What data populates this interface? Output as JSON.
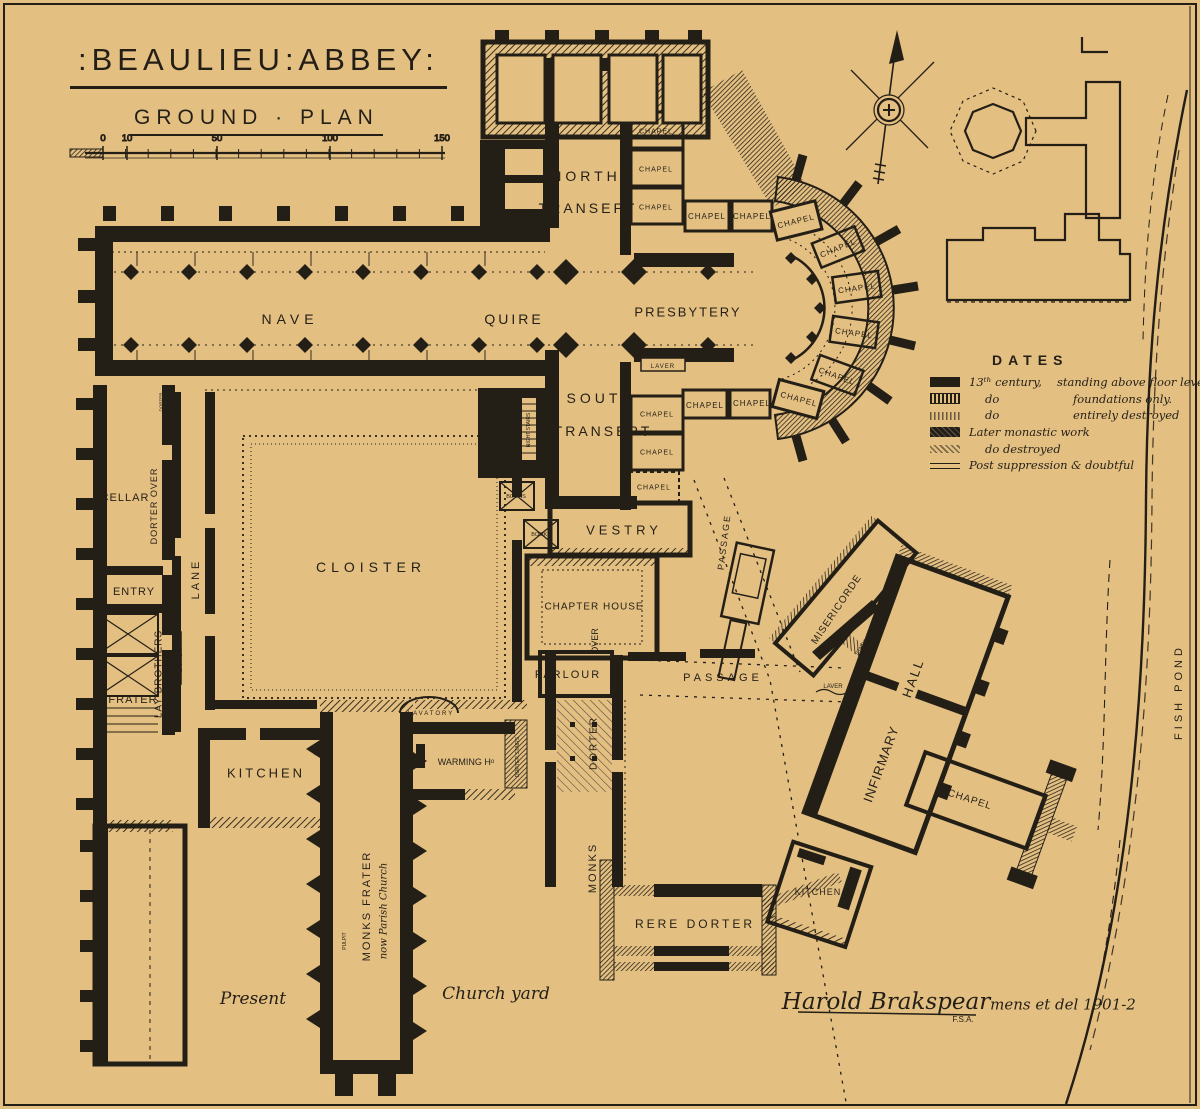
{
  "page": {
    "background": "#e3bf82",
    "ink": "#241f16"
  },
  "header": {
    "title": ":BEAULIEU:ABBEY:",
    "subtitle": "GROUND · PLAN"
  },
  "scale_bar": {
    "unit_ticks": [
      {
        "label": "0",
        "x": 103
      },
      {
        "label": "10",
        "x": 127
      },
      {
        "label": "50",
        "x": 217
      },
      {
        "label": "100",
        "x": 330
      },
      {
        "label": "150",
        "x": 442
      }
    ]
  },
  "legend": {
    "title": "DATES",
    "items": [
      {
        "swatch": "sw-solid",
        "t1": "13ᵗʰ century,",
        "t2": "standing above floor levels",
        "ind": false
      },
      {
        "swatch": "sw-found",
        "t1": "do",
        "t2": "foundations only.",
        "ind": true
      },
      {
        "swatch": "sw-destroyed",
        "t1": "do",
        "t2": "entirely destroyed",
        "ind": true
      },
      {
        "swatch": "sw-later",
        "t1": "Later monastic work",
        "t2": "",
        "ind": false
      },
      {
        "swatch": "sw-later-destroyed",
        "t1": "do  destroyed",
        "t2": "",
        "ind": true
      },
      {
        "swatch": "sw-post",
        "t1": "Post suppression & doubtful",
        "t2": "",
        "ind": false
      }
    ]
  },
  "plan": {
    "labels": [
      {
        "t": "NORTH",
        "x": 586,
        "y": 176,
        "s": 14,
        "ls": 4
      },
      {
        "t": "TRANSEPT",
        "x": 588,
        "y": 208,
        "s": 14,
        "ls": 3
      },
      {
        "t": "CHAPEL",
        "x": 656,
        "y": 131,
        "s": 7,
        "ls": 1
      },
      {
        "t": "CHAPEL",
        "x": 656,
        "y": 169,
        "s": 7,
        "ls": 1
      },
      {
        "t": "CHAPEL",
        "x": 656,
        "y": 207,
        "s": 7,
        "ls": 1
      },
      {
        "t": "CHAPEL",
        "x": 707,
        "y": 216,
        "s": 8,
        "ls": 1
      },
      {
        "t": "CHAPEL",
        "x": 752,
        "y": 216,
        "s": 8,
        "ls": 1
      },
      {
        "t": "CHAPEL",
        "x": 796,
        "y": 221,
        "s": 8,
        "ls": 1,
        "r": -14
      },
      {
        "t": "CHAPEL",
        "x": 838,
        "y": 248,
        "s": 8,
        "ls": 1,
        "r": -22
      },
      {
        "t": "CHAPEL",
        "x": 857,
        "y": 288,
        "s": 8,
        "ls": 1,
        "r": -8
      },
      {
        "t": "CHAPEL",
        "x": 854,
        "y": 333,
        "s": 8,
        "ls": 1,
        "r": 8
      },
      {
        "t": "CHAPEL",
        "x": 837,
        "y": 376,
        "s": 8,
        "ls": 1,
        "r": 20
      },
      {
        "t": "CHAPEL",
        "x": 799,
        "y": 399,
        "s": 8,
        "ls": 1,
        "r": 15
      },
      {
        "t": "CHAPEL",
        "x": 752,
        "y": 403,
        "s": 8,
        "ls": 1
      },
      {
        "t": "CHAPEL",
        "x": 705,
        "y": 405,
        "s": 8,
        "ls": 1
      },
      {
        "t": "NAVE",
        "x": 290,
        "y": 319,
        "s": 14,
        "ls": 5
      },
      {
        "t": "QUIRE",
        "x": 514,
        "y": 319,
        "s": 14,
        "ls": 3
      },
      {
        "t": "PRESBYTERY",
        "x": 688,
        "y": 312,
        "s": 13,
        "ls": 2
      },
      {
        "t": "LAVER",
        "x": 663,
        "y": 366,
        "s": 6,
        "ls": 1
      },
      {
        "t": "SOUTH",
        "x": 601,
        "y": 398,
        "s": 14,
        "ls": 4
      },
      {
        "t": "TRANSEPT",
        "x": 603,
        "y": 431,
        "s": 14,
        "ls": 3
      },
      {
        "t": "CHAPEL",
        "x": 657,
        "y": 414,
        "s": 7,
        "ls": 1
      },
      {
        "t": "CHAPEL",
        "x": 657,
        "y": 452,
        "s": 7,
        "ls": 1
      },
      {
        "t": "CHAPEL",
        "x": 654,
        "y": 487,
        "s": 7,
        "ls": 1
      },
      {
        "t": "NIGHT STAIRS",
        "x": 528,
        "y": 430,
        "s": 5,
        "r": -90
      },
      {
        "t": "BOOKS",
        "x": 516,
        "y": 496,
        "s": 5.5
      },
      {
        "t": "BOOKS",
        "x": 541,
        "y": 534,
        "s": 5.5
      },
      {
        "t": "VESTRY",
        "x": 624,
        "y": 530,
        "s": 13,
        "ls": 4
      },
      {
        "t": "PASSAGE",
        "x": 724,
        "y": 542,
        "s": 9,
        "ls": 2,
        "r": -83
      },
      {
        "t": "CHAPTER HOUSE",
        "x": 594,
        "y": 606,
        "s": 10,
        "ls": 1
      },
      {
        "t": "OVER",
        "x": 595,
        "y": 641,
        "s": 9,
        "r": -90
      },
      {
        "t": "PARLOUR",
        "x": 568,
        "y": 674,
        "s": 11,
        "ls": 2
      },
      {
        "t": "PASSAGE",
        "x": 723,
        "y": 677,
        "s": 11,
        "ls": 4
      },
      {
        "t": "DORTER",
        "x": 593,
        "y": 743,
        "s": 10,
        "ls": 2,
        "r": -90
      },
      {
        "t": "MONKS",
        "x": 592,
        "y": 868,
        "s": 11,
        "ls": 2,
        "r": -90
      },
      {
        "t": "CLOISTER",
        "x": 371,
        "y": 567,
        "s": 14,
        "ls": 5
      },
      {
        "t": "LANE",
        "x": 195,
        "y": 579,
        "s": 11,
        "ls": 3,
        "r": -90
      },
      {
        "t": "LAVATORY",
        "x": 180,
        "y": 659,
        "s": 5,
        "r": -90
      },
      {
        "t": "DORTER",
        "x": 161,
        "y": 402,
        "s": 4.5,
        "r": -90
      },
      {
        "t": "CELLAR",
        "x": 125,
        "y": 497,
        "s": 11,
        "ls": 1
      },
      {
        "t": "DORTER OVER",
        "x": 154,
        "y": 506,
        "s": 9,
        "ls": 1,
        "r": -90
      },
      {
        "t": "ENTRY",
        "x": 134,
        "y": 591,
        "s": 11,
        "ls": 1
      },
      {
        "t": "LAY BROTHERS",
        "x": 158,
        "y": 674,
        "s": 10,
        "ls": 1,
        "r": -90
      },
      {
        "t": "FRATER",
        "x": 133,
        "y": 699,
        "s": 11,
        "ls": 1
      },
      {
        "t": "KITCHEN",
        "x": 266,
        "y": 773,
        "s": 13,
        "ls": 3
      },
      {
        "t": "HATCH",
        "x": 323,
        "y": 753,
        "s": 5.5
      },
      {
        "t": "LAVATORY",
        "x": 431,
        "y": 713,
        "s": 6,
        "ls": 2
      },
      {
        "t": "FIRE",
        "x": 421,
        "y": 760,
        "s": 5,
        "r": -90
      },
      {
        "t": "WARMING Hᵒ",
        "x": 466,
        "y": 762,
        "s": 9
      },
      {
        "t": "DORTER STAIRS",
        "x": 517,
        "y": 757,
        "s": 5,
        "r": -90
      },
      {
        "t": "MONKS FRATER",
        "x": 366,
        "y": 906,
        "s": 11,
        "ls": 2,
        "r": -90
      },
      {
        "t": "now Parish Church",
        "x": 383,
        "y": 911,
        "s": 10,
        "r": -90,
        "cls": "script"
      },
      {
        "t": "PULPIT",
        "x": 344,
        "y": 941,
        "s": 5,
        "r": -90
      },
      {
        "t": "MISERICORDE",
        "x": 836,
        "y": 609,
        "s": 10,
        "ls": 1,
        "r": -56
      },
      {
        "t": "STAIRS",
        "x": 861,
        "y": 647,
        "s": 5,
        "r": -56
      },
      {
        "t": "LAVER",
        "x": 833,
        "y": 686,
        "s": 6
      },
      {
        "t": "HALL",
        "x": 913,
        "y": 678,
        "s": 13,
        "ls": 2,
        "r": -70
      },
      {
        "t": "INFIRMARY",
        "x": 881,
        "y": 764,
        "s": 13,
        "ls": 1,
        "r": -70
      },
      {
        "t": "CHAPEL",
        "x": 970,
        "y": 799,
        "s": 10,
        "ls": 1,
        "r": 18
      },
      {
        "t": "KITCHEN",
        "x": 818,
        "y": 892,
        "s": 9,
        "ls": 1
      },
      {
        "t": "RERE DORTER",
        "x": 695,
        "y": 924,
        "s": 12,
        "ls": 3
      },
      {
        "t": "FISH POND",
        "x": 1178,
        "y": 692,
        "s": 11,
        "ls": 4,
        "r": -90
      },
      {
        "t": "Present",
        "x": 253,
        "y": 998,
        "s": 17,
        "cls": "script"
      },
      {
        "t": "Church yard",
        "x": 496,
        "y": 993,
        "s": 17,
        "cls": "script"
      },
      {
        "t": "Harold Brakspear",
        "x": 886,
        "y": 1001,
        "s": 23,
        "cls": "script"
      },
      {
        "t": "F.S.A.",
        "x": 963,
        "y": 1019,
        "s": 8
      },
      {
        "t": "mens et del 1901-2",
        "x": 1063,
        "y": 1004,
        "s": 15,
        "cls": "script"
      }
    ]
  }
}
